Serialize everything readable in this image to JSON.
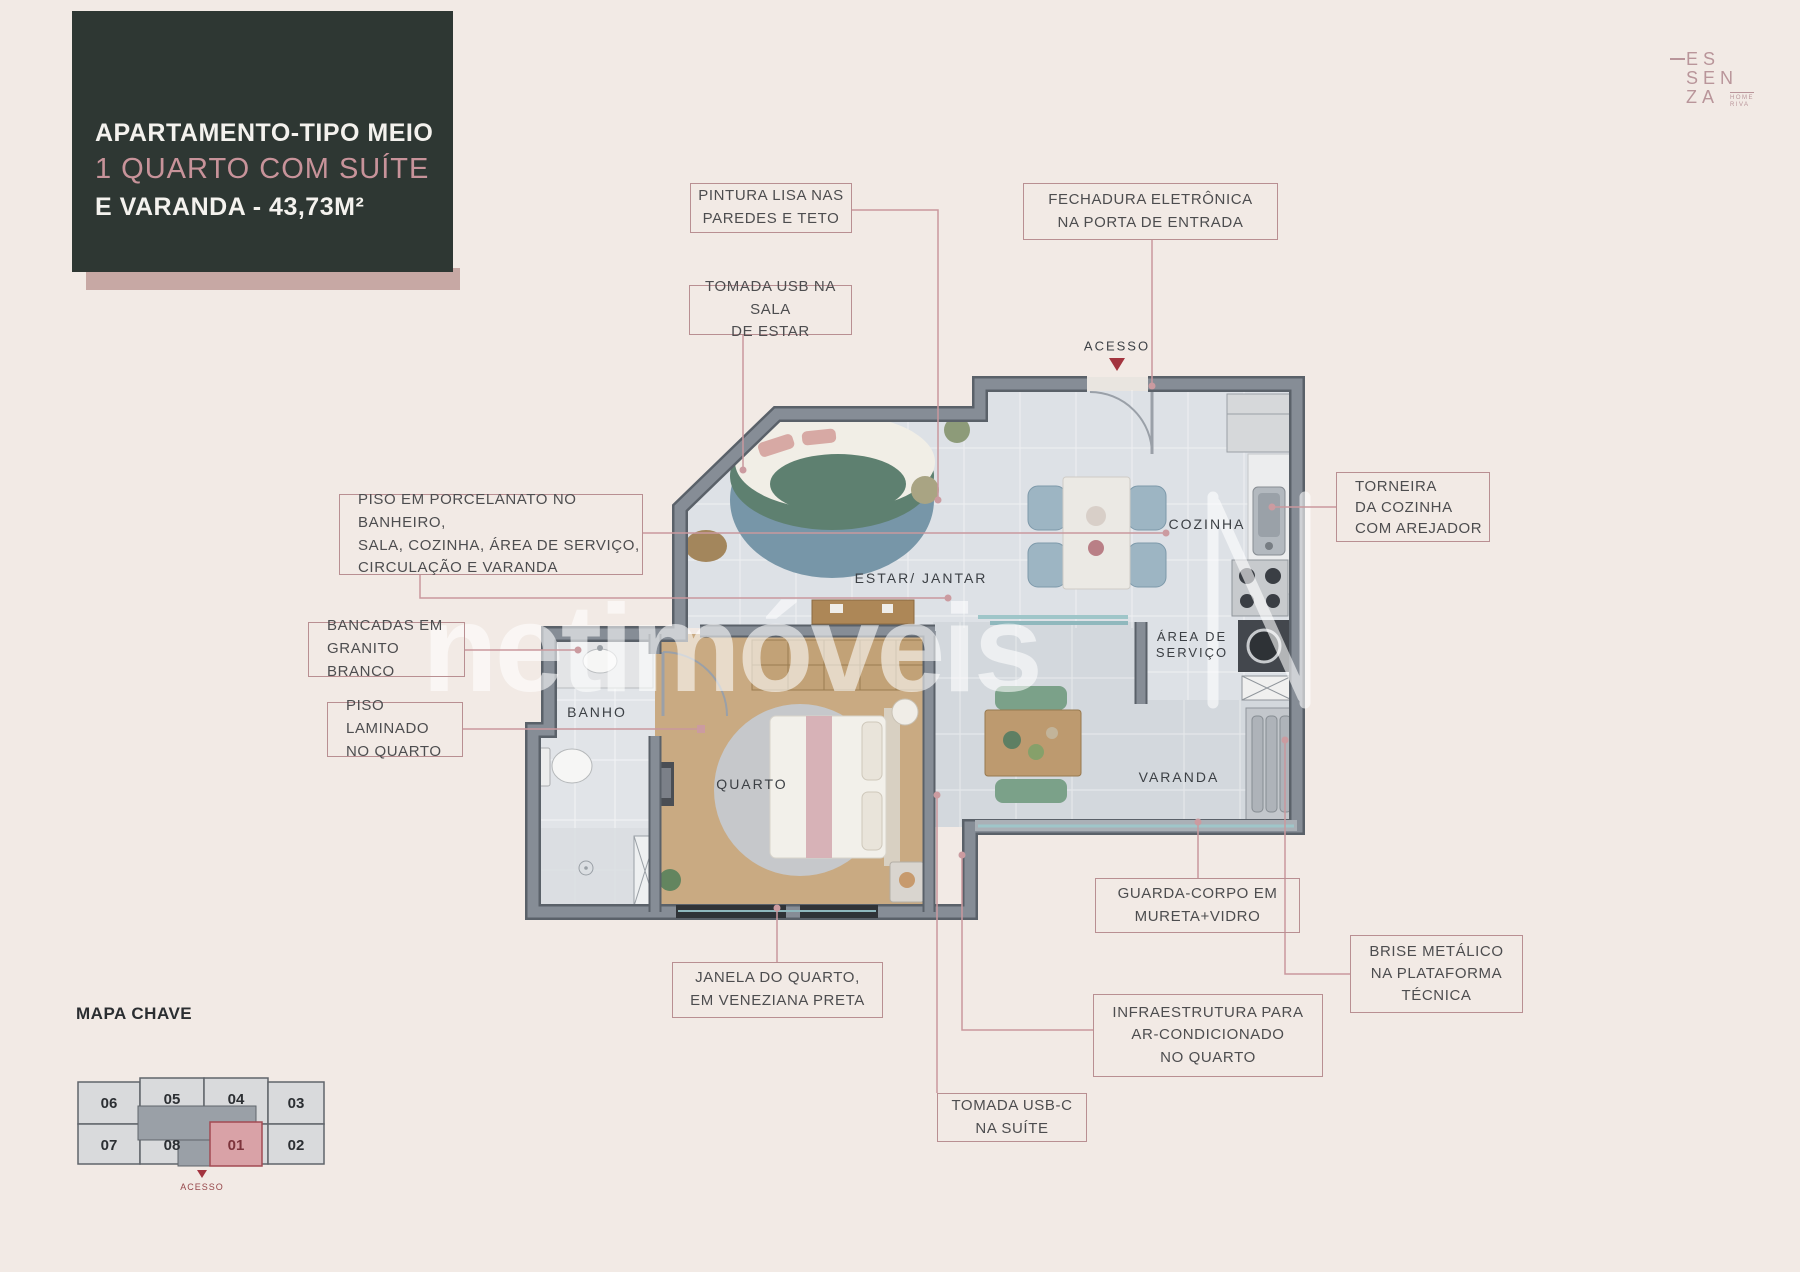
{
  "header": {
    "title_line1": "APARTAMENTO-TIPO MEIO",
    "title_line2": "1 QUARTO COM SUÍTE",
    "title_line3": "E VARANDA - 43,73M²"
  },
  "logo": {
    "line1": "ES",
    "line2": "SEN",
    "line3": "ZA",
    "sub1": "HOME",
    "sub2": "RIVA"
  },
  "watermark": {
    "text": "netimóveis"
  },
  "callouts": [
    {
      "id": "pintura",
      "lines": [
        "PINTURA LISA NAS",
        "PAREDES E TETO"
      ]
    },
    {
      "id": "fechadura",
      "lines": [
        "FECHADURA ELETRÔNICA",
        "NA PORTA DE ENTRADA"
      ]
    },
    {
      "id": "tomada-usb",
      "lines": [
        "TOMADA USB NA SALA",
        "DE ESTAR"
      ]
    },
    {
      "id": "torneira",
      "lines": [
        "TORNEIRA",
        "DA COZINHA",
        "COM AREJADOR"
      ]
    },
    {
      "id": "piso-porcelanato",
      "lines": [
        "PISO EM PORCELANATO NO BANHEIRO,",
        "SALA, COZINHA, ÁREA DE SERVIÇO,",
        "CIRCULAÇÃO E VARANDA"
      ]
    },
    {
      "id": "bancadas",
      "lines": [
        "BANCADAS EM",
        "GRANITO BRANCO"
      ]
    },
    {
      "id": "piso-laminado",
      "lines": [
        "PISO LAMINADO",
        "NO QUARTO"
      ]
    },
    {
      "id": "janela",
      "lines": [
        "JANELA DO QUARTO,",
        "EM VENEZIANA PRETA"
      ]
    },
    {
      "id": "guarda-corpo",
      "lines": [
        "GUARDA-CORPO EM",
        "MURETA+VIDRO"
      ]
    },
    {
      "id": "brise",
      "lines": [
        "BRISE METÁLICO",
        "NA PLATAFORMA",
        "TÉCNICA"
      ]
    },
    {
      "id": "infraestrutura",
      "lines": [
        "INFRAESTRUTURA PARA",
        "AR-CONDICIONADO",
        "NO QUARTO"
      ]
    },
    {
      "id": "tomada-usbc",
      "lines": [
        "TOMADA USB-C",
        "NA SUÍTE"
      ]
    }
  ],
  "rooms": {
    "acesso": "ACESSO",
    "cozinha": "COZINHA",
    "estar_jantar": "ESTAR/ JANTAR",
    "area_servico_1": "ÁREA DE",
    "area_servico_2": "SERVIÇO",
    "banho": "BANHO",
    "quarto": "QUARTO",
    "varanda": "VARANDA"
  },
  "map": {
    "title": "MAPA CHAVE",
    "units": [
      "06",
      "05",
      "04",
      "03",
      "07",
      "08",
      "01",
      "02"
    ],
    "highlighted_unit": "01",
    "acesso": "ACESSO"
  },
  "colors": {
    "background": "#f2eae5",
    "title_box": "#2e3733",
    "accent_pink": "#c8939a",
    "callout_border": "#b98f92",
    "connector_line": "#c9989d",
    "acesso_red": "#a3343f",
    "wall_gray": "#7e858e",
    "highlight_unit": "#d9a2a7"
  }
}
